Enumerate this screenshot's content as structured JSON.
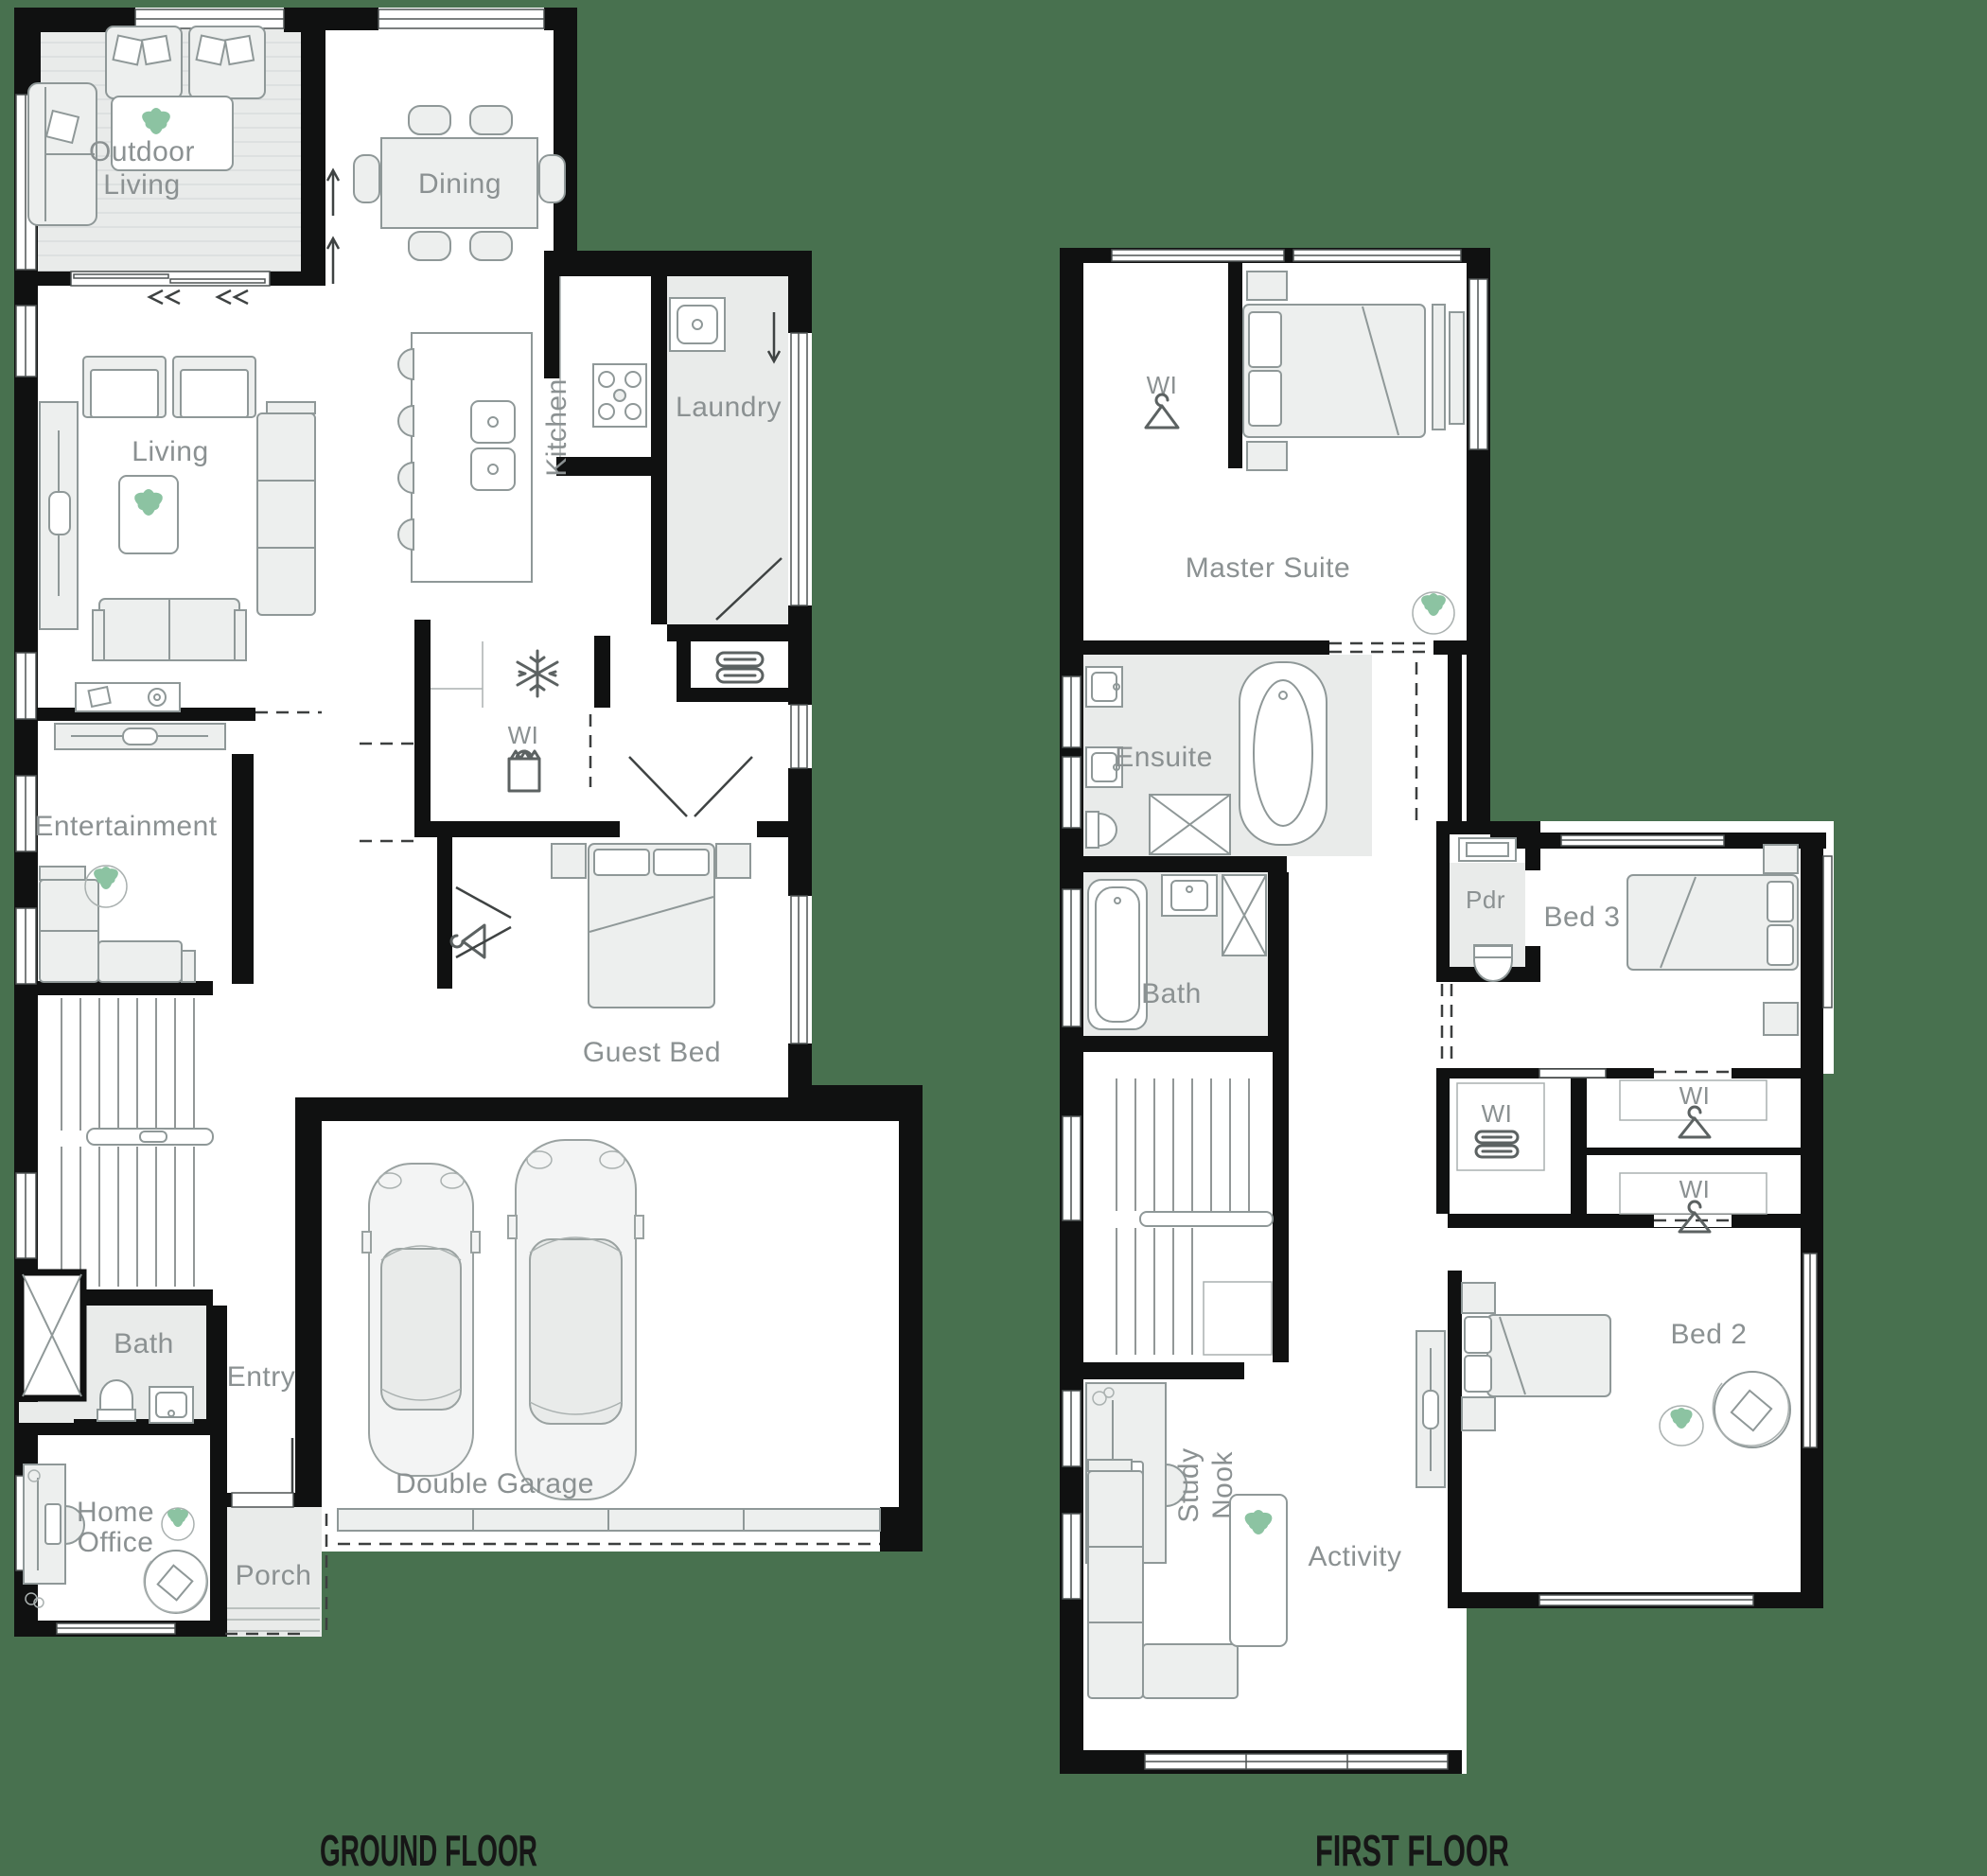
{
  "page": {
    "background_color": "#48714F",
    "type": "architectural-floor-plan",
    "plans": [
      "GROUND FLOOR",
      "FIRST FLOOR"
    ]
  },
  "palette": {
    "wall": "#101111",
    "room_fill": "#ffffff",
    "shaded_room_fill": "#e9ebea",
    "furniture_fill": "#edefee",
    "furniture_stroke": "#8f9898",
    "label_gray": "#8b9192",
    "title_dark": "#161616",
    "plant_green": "#8cc3a2"
  },
  "ground_floor": {
    "title": "GROUND FLOOR",
    "labels": {
      "outdoor_living_1": "Outdoor",
      "outdoor_living_2": "Living",
      "dining": "Dining",
      "living": "Living",
      "kitchen": "Kitchen",
      "laundry": "Laundry",
      "wi_pantry": "WI",
      "entertainment": "Entertainment",
      "guest_bed": "Guest Bed",
      "bath": "Bath",
      "entry": "Entry",
      "home_office_1": "Home",
      "home_office_2": "Office",
      "porch": "Porch",
      "double_garage": "Double Garage"
    },
    "icons": [
      "plant-icon",
      "snowflake-fridge-icon",
      "shopping-bag-pantry-icon",
      "linen-towels-icon",
      "hanger-wardrobe-icon",
      "car-icon",
      "stairs",
      "door-swing",
      "slider-arrows"
    ]
  },
  "first_floor": {
    "title": "FIRST FLOOR",
    "labels": {
      "wi_master": "WI",
      "master_suite": "Master Suite",
      "ensuite": "Ensuite",
      "bath": "Bath",
      "pdr": "Pdr",
      "bed_3": "Bed 3",
      "wi_linen": "WI",
      "wi_robe_1": "WI",
      "wi_robe_2": "WI",
      "study_nook_1": "Study",
      "study_nook_2": "Nook",
      "activity": "Activity",
      "bed_2": "Bed 2"
    },
    "icons": [
      "plant-icon",
      "hanger-wardrobe-icon",
      "linen-towels-icon",
      "stairs",
      "bathtub-icon",
      "shower-icon",
      "toilet-icon"
    ]
  }
}
